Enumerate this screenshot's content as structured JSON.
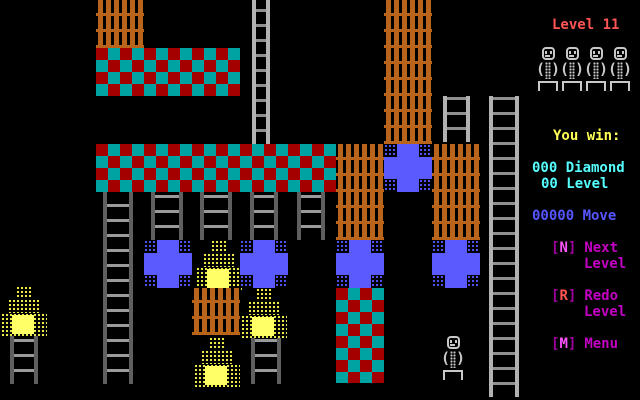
{
  "panel": {
    "level_label": "Level 11",
    "you_win": "You win:",
    "lives": {
      "count": 4
    },
    "stats": {
      "diamond": {
        "text": "000 Diamond"
      },
      "level": {
        "text": "00 Level"
      },
      "move": {
        "text": "00000 Move"
      }
    },
    "menu": [
      {
        "ob": "[",
        "key": "N",
        "cb": "]",
        "label": "Next",
        "label2": "Level"
      },
      {
        "ob": "[",
        "key": "R",
        "cb": "]",
        "label": "Redo",
        "label2": "Level"
      },
      {
        "ob": "[",
        "key": "M",
        "cb": "]",
        "label": "Menu",
        "label2": ""
      }
    ],
    "colors": {
      "level_label": "#ff5555",
      "you_win": "#ffff55",
      "diamond_level": "#55ffff",
      "move": "#5555ff",
      "menu_word": "#c300c3",
      "menu_bracket": "#9f009f",
      "menu_key": "#ff55ff"
    }
  },
  "sprites": {
    "paren_open": "(",
    "paren_close": ")",
    "brick_color": "#b9641a",
    "checker_teal": "#00a2a2",
    "checker_red": "#a40000",
    "cross_blue": "#5a5aff",
    "flame_yellow": "#ffff66",
    "player_gray": "#c8c8c8"
  },
  "game": {
    "tiles": [
      {
        "type": "brick",
        "x": 96,
        "y": 0,
        "w": 48,
        "h": 48
      },
      {
        "type": "brick",
        "x": 384,
        "y": 0,
        "w": 48,
        "h": 144
      },
      {
        "type": "checker",
        "x": 96,
        "y": 48,
        "w": 144,
        "h": 48
      },
      {
        "type": "ladder",
        "variant": "light",
        "x": 252,
        "y": 0,
        "w": 18,
        "h": 144
      },
      {
        "type": "ladder",
        "variant": "light",
        "x": 443,
        "y": 96,
        "w": 27,
        "h": 46
      },
      {
        "type": "ladder",
        "variant": "light",
        "x": 489,
        "y": 96,
        "w": 30,
        "h": 301
      },
      {
        "type": "checker",
        "x": 96,
        "y": 144,
        "w": 240,
        "h": 48
      },
      {
        "type": "brick",
        "x": 336,
        "y": 144,
        "w": 48,
        "h": 96
      },
      {
        "type": "cross",
        "x": 384,
        "y": 144
      },
      {
        "type": "brick",
        "x": 432,
        "y": 144,
        "w": 48,
        "h": 96
      },
      {
        "type": "ladder",
        "variant": "dark",
        "x": 103,
        "y": 192,
        "w": 30,
        "h": 192
      },
      {
        "type": "ladder",
        "variant": "dark",
        "x": 151,
        "y": 192,
        "w": 32,
        "h": 48
      },
      {
        "type": "ladder",
        "variant": "dark",
        "x": 200,
        "y": 192,
        "w": 32,
        "h": 48
      },
      {
        "type": "ladder",
        "variant": "dark",
        "x": 250,
        "y": 192,
        "w": 28,
        "h": 48
      },
      {
        "type": "ladder",
        "variant": "dark",
        "x": 297,
        "y": 192,
        "w": 28,
        "h": 48
      },
      {
        "type": "cross",
        "x": 144,
        "y": 240
      },
      {
        "type": "flame",
        "x": 196,
        "y": 240
      },
      {
        "type": "cross",
        "x": 240,
        "y": 240
      },
      {
        "type": "cross",
        "x": 336,
        "y": 240
      },
      {
        "type": "cross",
        "x": 432,
        "y": 240
      },
      {
        "type": "flame",
        "x": 1,
        "y": 286
      },
      {
        "type": "brick",
        "x": 192,
        "y": 288,
        "w": 48,
        "h": 47
      },
      {
        "type": "flame",
        "x": 241,
        "y": 288
      },
      {
        "type": "checker",
        "x": 336,
        "y": 288,
        "w": 48,
        "h": 95
      },
      {
        "type": "ladder",
        "variant": "dark",
        "x": 10,
        "y": 336,
        "w": 28,
        "h": 48
      },
      {
        "type": "flame",
        "x": 194,
        "y": 337
      },
      {
        "type": "ladder",
        "variant": "dark",
        "x": 251,
        "y": 338,
        "w": 30,
        "h": 46
      },
      {
        "type": "guy",
        "x": 441,
        "y": 336
      }
    ]
  }
}
